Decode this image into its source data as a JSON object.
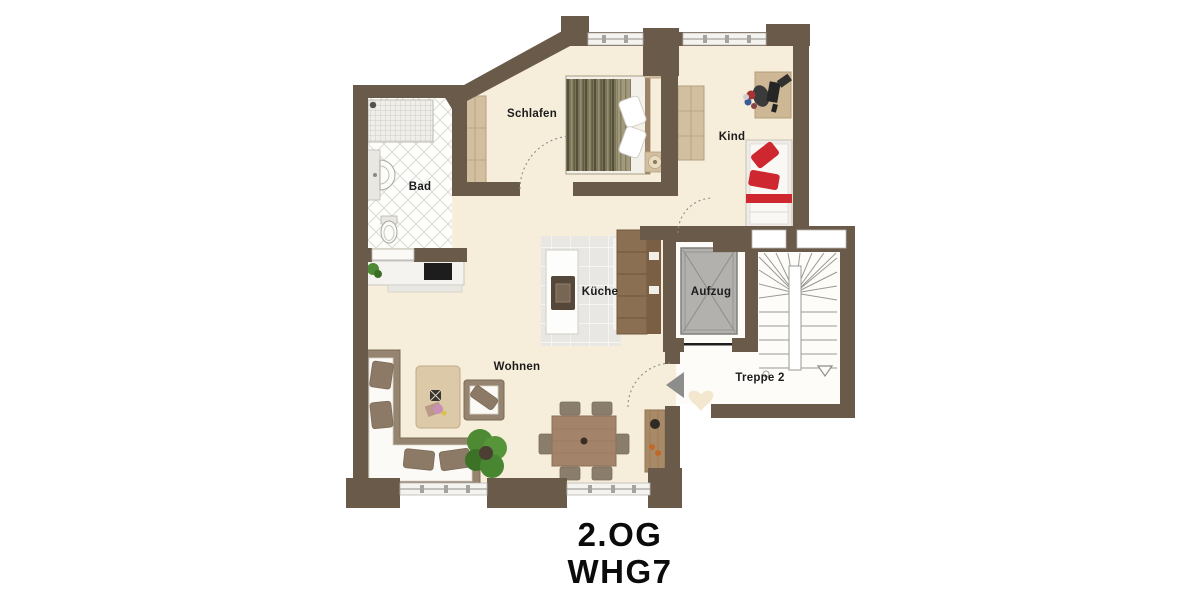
{
  "floor_plan": {
    "title_line1": "2.OG",
    "title_line2": "WHG7",
    "rooms": {
      "schlafen": "Schlafen",
      "kind": "Kind",
      "bad": "Bad",
      "kueche": "Küche",
      "wohnen": "Wohnen",
      "aufzug": "Aufzug",
      "treppe": "Treppe 2"
    },
    "colors": {
      "wall": "#6a5a49",
      "floor": "#f6eedb",
      "bath_floor": "#fdfdfb",
      "kitchen_tile": "#e8e7e3",
      "stair_hall": "#fdfcf9",
      "elevator": "#b2b1ae",
      "accent_red": "#cf2730",
      "wood_dark": "#8b6f52",
      "wood_light": "#d2bf9f",
      "plant_green": "#4e8a33",
      "label_text": "#1c1c1c"
    }
  }
}
